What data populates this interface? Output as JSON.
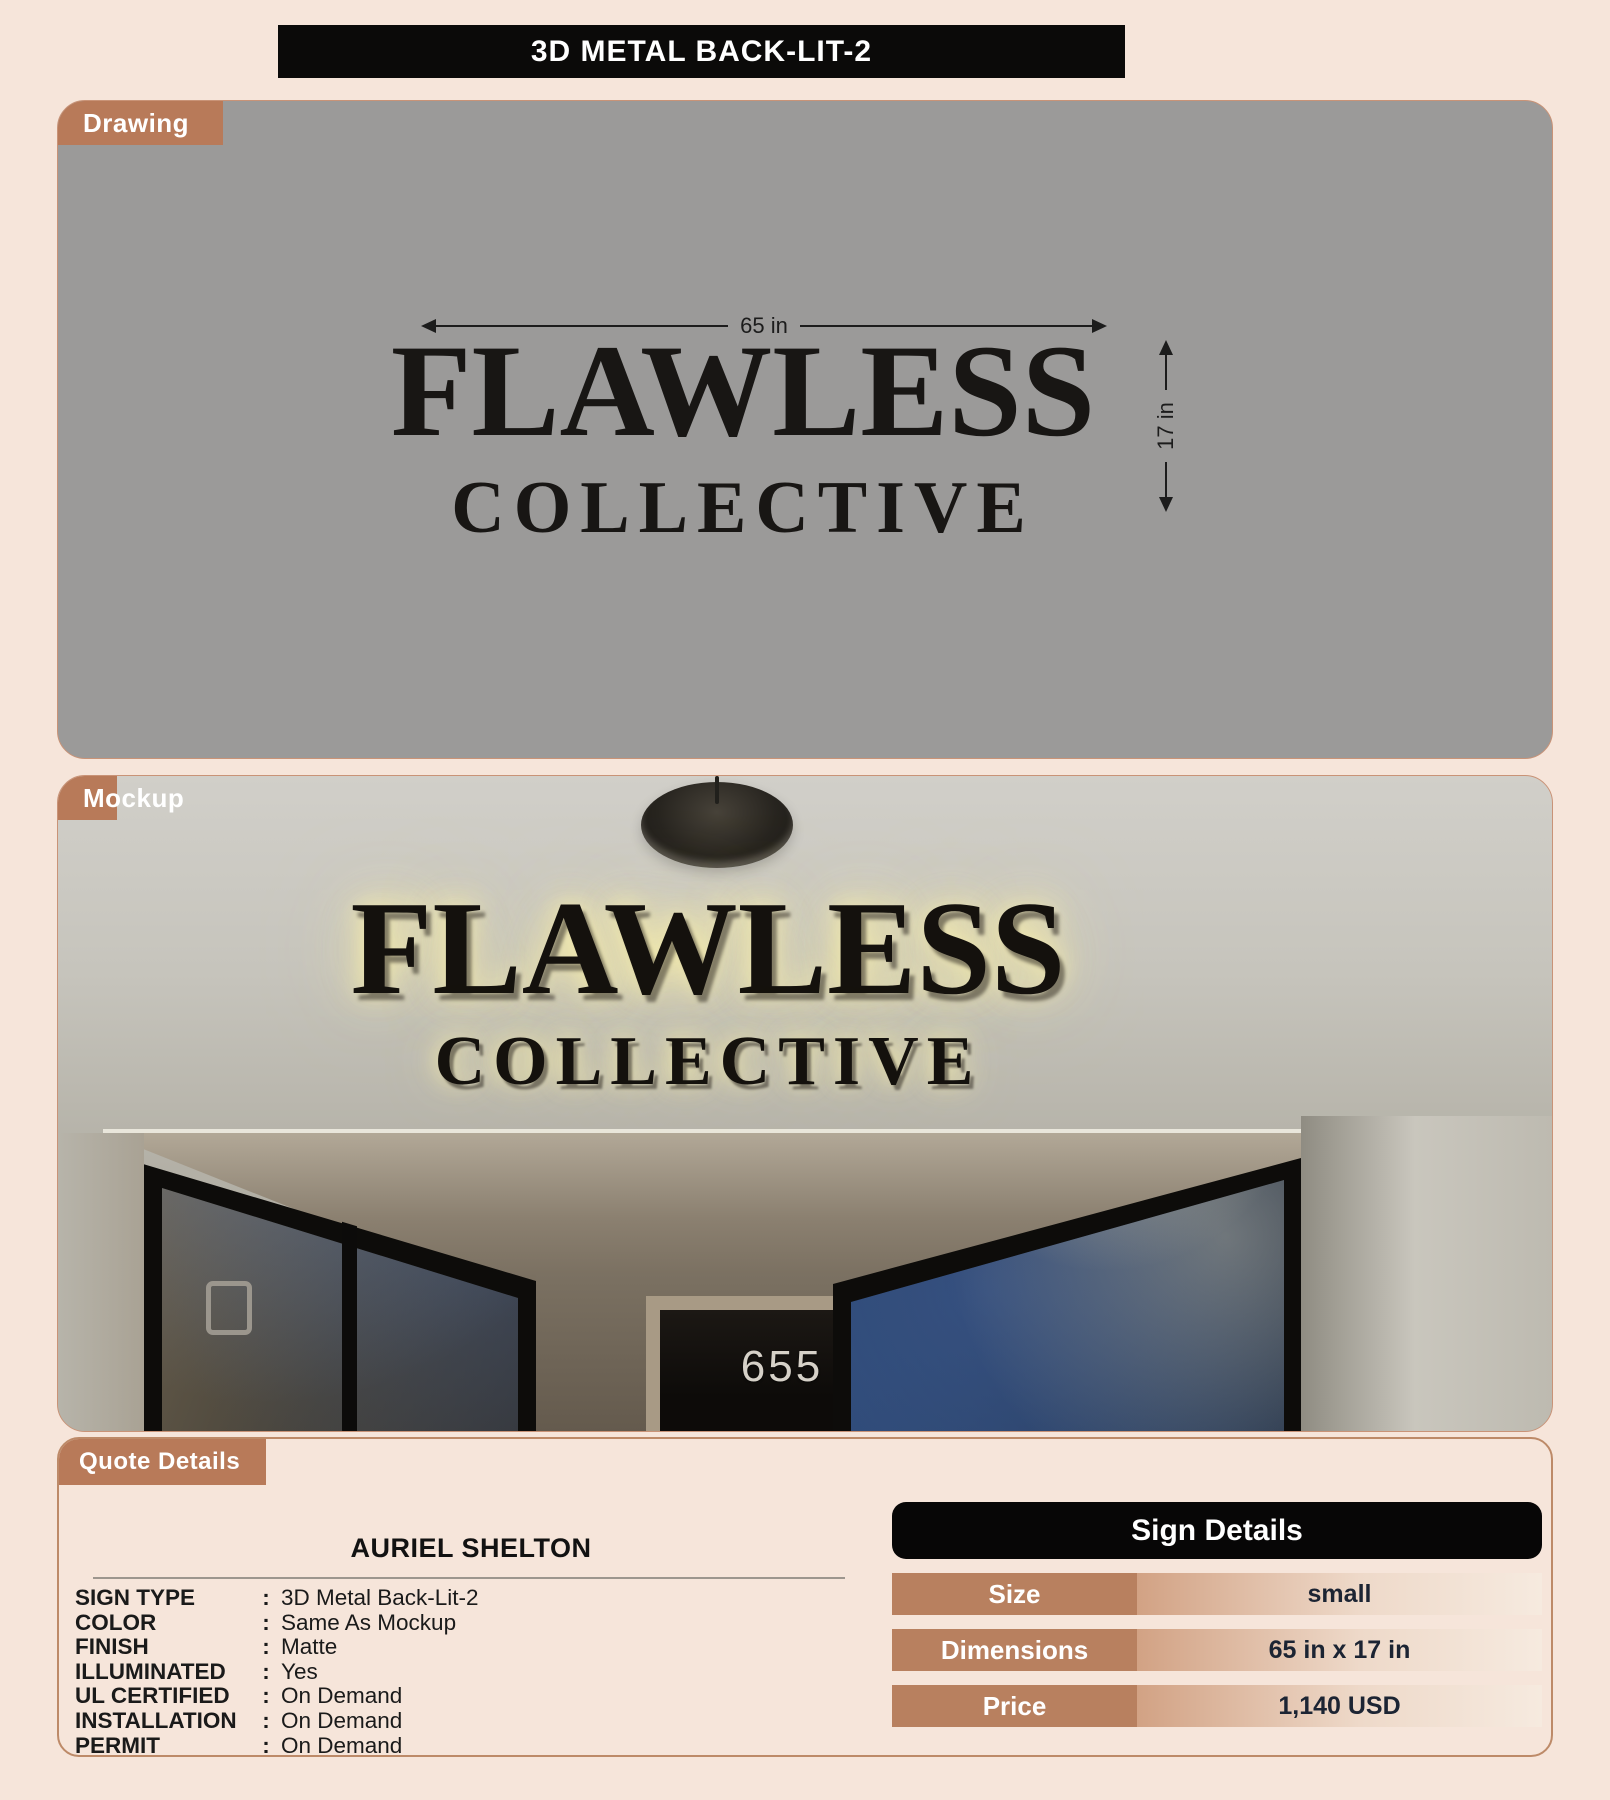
{
  "page": {
    "title": "3D METAL BACK-LIT-2",
    "background_color": "#f6e5da",
    "accent_color": "#b87a59",
    "header_bar_color": "#0b0a09"
  },
  "drawing": {
    "label": "Drawing",
    "canvas_color": "#9b9a99",
    "sign_line1": "FLAWLESS",
    "sign_line2": "COLLECTIVE",
    "width_dimension": "65 in",
    "height_dimension": "17 in"
  },
  "mockup": {
    "label": "Mockup",
    "sign_line1": "FLAWLESS",
    "sign_line2": "COLLECTIVE",
    "door_number": "655",
    "glow_color": "#f9eeae"
  },
  "quote": {
    "label": "Quote Details",
    "customer": "AURIEL SHELTON",
    "colon": ":",
    "rows": [
      {
        "label": "SIGN TYPE",
        "value": "3D Metal Back-Lit-2"
      },
      {
        "label": "COLOR",
        "value": "Same As Mockup"
      },
      {
        "label": "FINISH",
        "value": "Matte"
      },
      {
        "label": "ILLUMINATED",
        "value": "Yes"
      },
      {
        "label": "UL CERTIFIED",
        "value": "On Demand"
      },
      {
        "label": "INSTALLATION",
        "value": "On Demand"
      },
      {
        "label": "PERMIT",
        "value": "On Demand"
      }
    ]
  },
  "sign_details": {
    "title": "Sign Details",
    "label_bg_color": "#b8805f",
    "rows": [
      {
        "label": "Size",
        "value": "small"
      },
      {
        "label": "Dimensions",
        "value": "65 in x 17 in"
      },
      {
        "label": "Price",
        "value": "1,140 USD"
      }
    ]
  }
}
